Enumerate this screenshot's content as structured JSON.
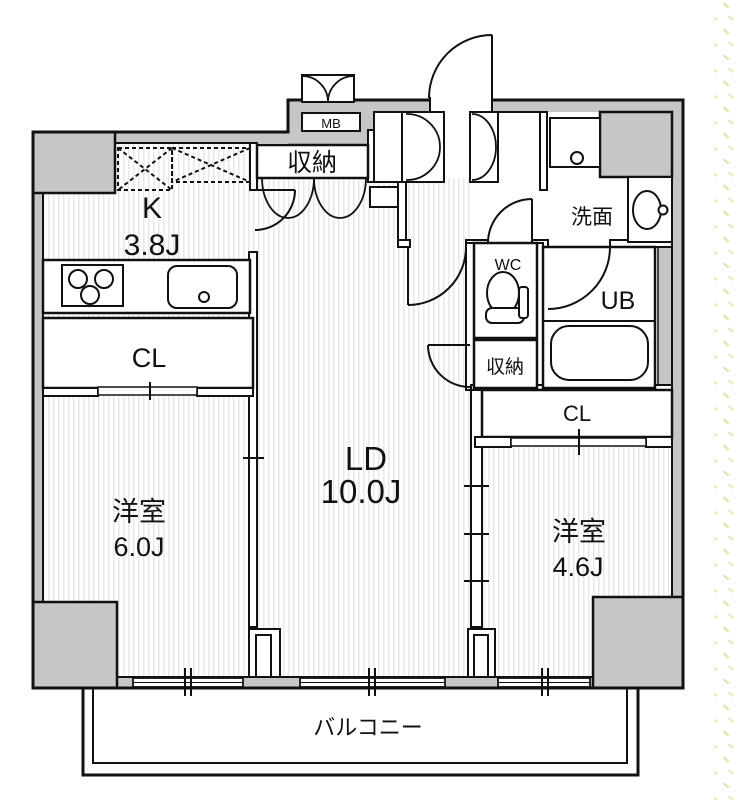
{
  "plan_title": "1LDK+2 apartment floor plan",
  "rooms": {
    "kitchen": {
      "label": "K",
      "size": "3.8J"
    },
    "living_dining": {
      "label": "LD",
      "size": "10.0J"
    },
    "bedroom_left": {
      "label": "洋室",
      "size": "6.0J"
    },
    "bedroom_right": {
      "label": "洋室",
      "size": "4.6J"
    }
  },
  "closets": {
    "left": "CL",
    "right": "CL"
  },
  "storage": {
    "top": "収納",
    "middle": "収納"
  },
  "sanitary": {
    "wc": "WC",
    "washroom": "洗面",
    "unit_bath": "UB"
  },
  "meter_box": "MB",
  "balcony": "バルコニー",
  "icons": [
    "stove-burners-icon",
    "kitchen-sink-icon",
    "toilet-icon",
    "bathtub-icon",
    "wash-basin-icon",
    "washing-machine-pan-icon",
    "door-swing-icon",
    "double-door-icon",
    "sliding-window-icon"
  ],
  "colors": {
    "wall_fill": "#c6c6c6",
    "line": "#111111",
    "floor_stripe": "#e2e2e2",
    "margin_dots": "#e9e3b2"
  }
}
